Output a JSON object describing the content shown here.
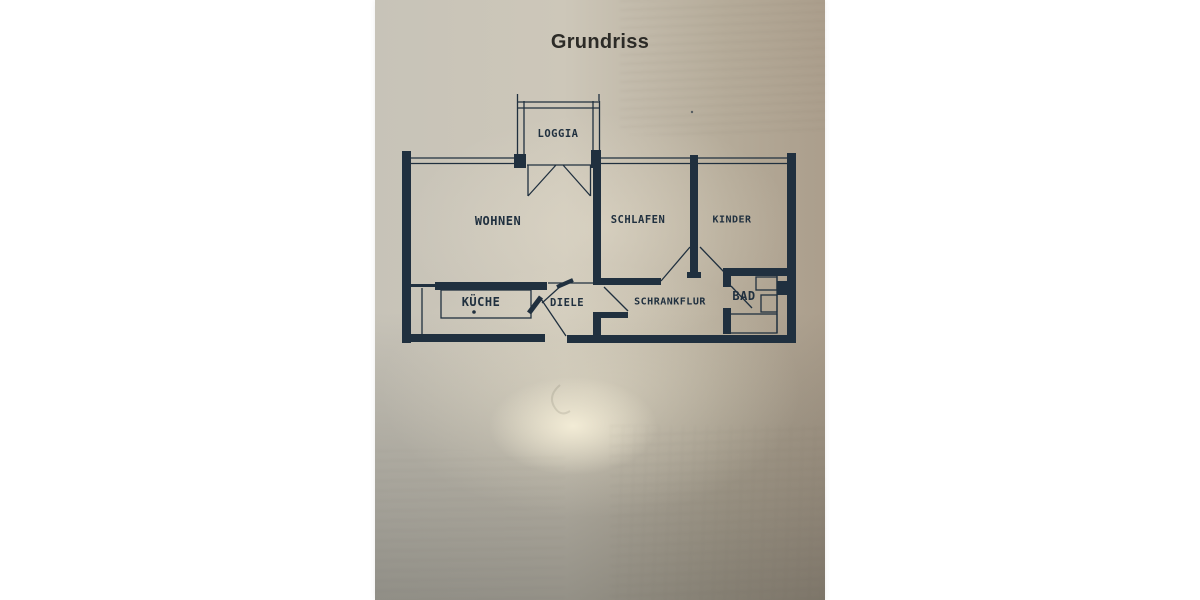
{
  "document": {
    "title": "Grundriss"
  },
  "floor_plan": {
    "rooms": [
      {
        "id": "loggia",
        "label": "LOGGIA"
      },
      {
        "id": "wohnen",
        "label": "WOHNEN"
      },
      {
        "id": "schlafen",
        "label": "SCHLAFEN"
      },
      {
        "id": "kinder",
        "label": "KINDER"
      },
      {
        "id": "kueche",
        "label": "KÜCHE"
      },
      {
        "id": "diele",
        "label": "DIELE"
      },
      {
        "id": "schrankflur",
        "label": "SCHRANKFLUR"
      },
      {
        "id": "bad",
        "label": "BAD"
      }
    ],
    "colors": {
      "ink": "#20303f",
      "paper_light": "#cdc7b9",
      "paper_dark": "#8d8c85",
      "title_ink": "#2c2b27"
    }
  }
}
